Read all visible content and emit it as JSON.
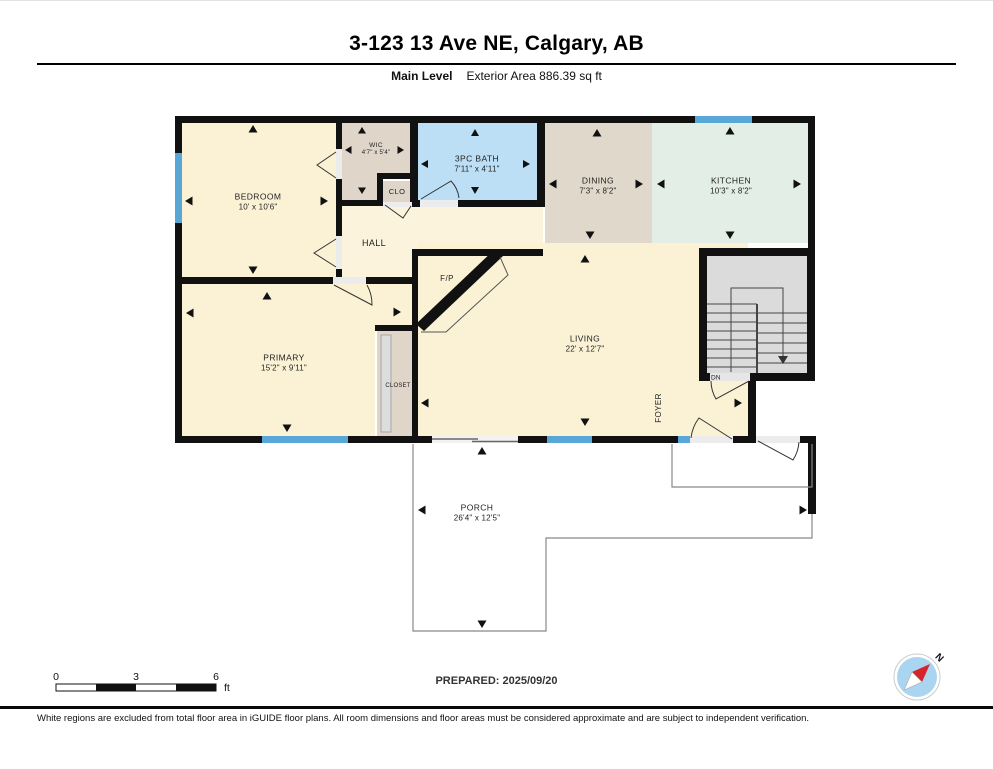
{
  "header": {
    "title": "3-123 13 Ave NE, Calgary, AB",
    "level_label": "Main Level",
    "area_label": "Exterior Area 886.39 sq ft"
  },
  "rooms": {
    "bedroom": {
      "name": "BEDROOM",
      "dims": "10' x 10'6\""
    },
    "wic": {
      "name": "WIC",
      "dims": "4'7\" x 5'4\""
    },
    "clo": {
      "name": "CLO"
    },
    "hall": {
      "name": "HALL"
    },
    "bath": {
      "name": "3PC BATH",
      "dims": "7'11\" x 4'11\""
    },
    "dining": {
      "name": "DINING",
      "dims": "7'3\" x 8'2\""
    },
    "kitchen": {
      "name": "KITCHEN",
      "dims": "10'3\" x 8'2\""
    },
    "living": {
      "name": "LIVING",
      "dims": "22' x 12'7\""
    },
    "primary": {
      "name": "PRIMARY",
      "dims": "15'2\" x 9'11\""
    },
    "closet": {
      "name": "CLOSET"
    },
    "foyer": {
      "name": "FOYER"
    },
    "fireplace": {
      "name": "F/P"
    },
    "stairs": {
      "name": "DN"
    },
    "porch": {
      "name": "PORCH",
      "dims": "26'4\" x 12'5\""
    }
  },
  "scale_bar": {
    "tick_0": "0",
    "tick_3": "3",
    "tick_6": "6",
    "unit": "ft"
  },
  "footer": {
    "prepared": "PREPARED: 2025/09/20",
    "disclaimer": "White regions are excluded from total floor area in iGUIDE floor plans. All room dimensions and floor areas must be considered approximate and are subject to independent verification."
  },
  "compass": {
    "north_label": "N"
  },
  "colors": {
    "room_cream": "#FBF2D5",
    "room_tan": "#DFD6C9",
    "bath_blue": "#BCDFF5",
    "kitchen_mint": "#E3EEE6",
    "stairs_gray": "#DBDBDB",
    "window_blue": "#58A7D6",
    "wall_black": "#111111",
    "compass_blue": "#A9D5F0",
    "compass_red": "#D8232A"
  }
}
